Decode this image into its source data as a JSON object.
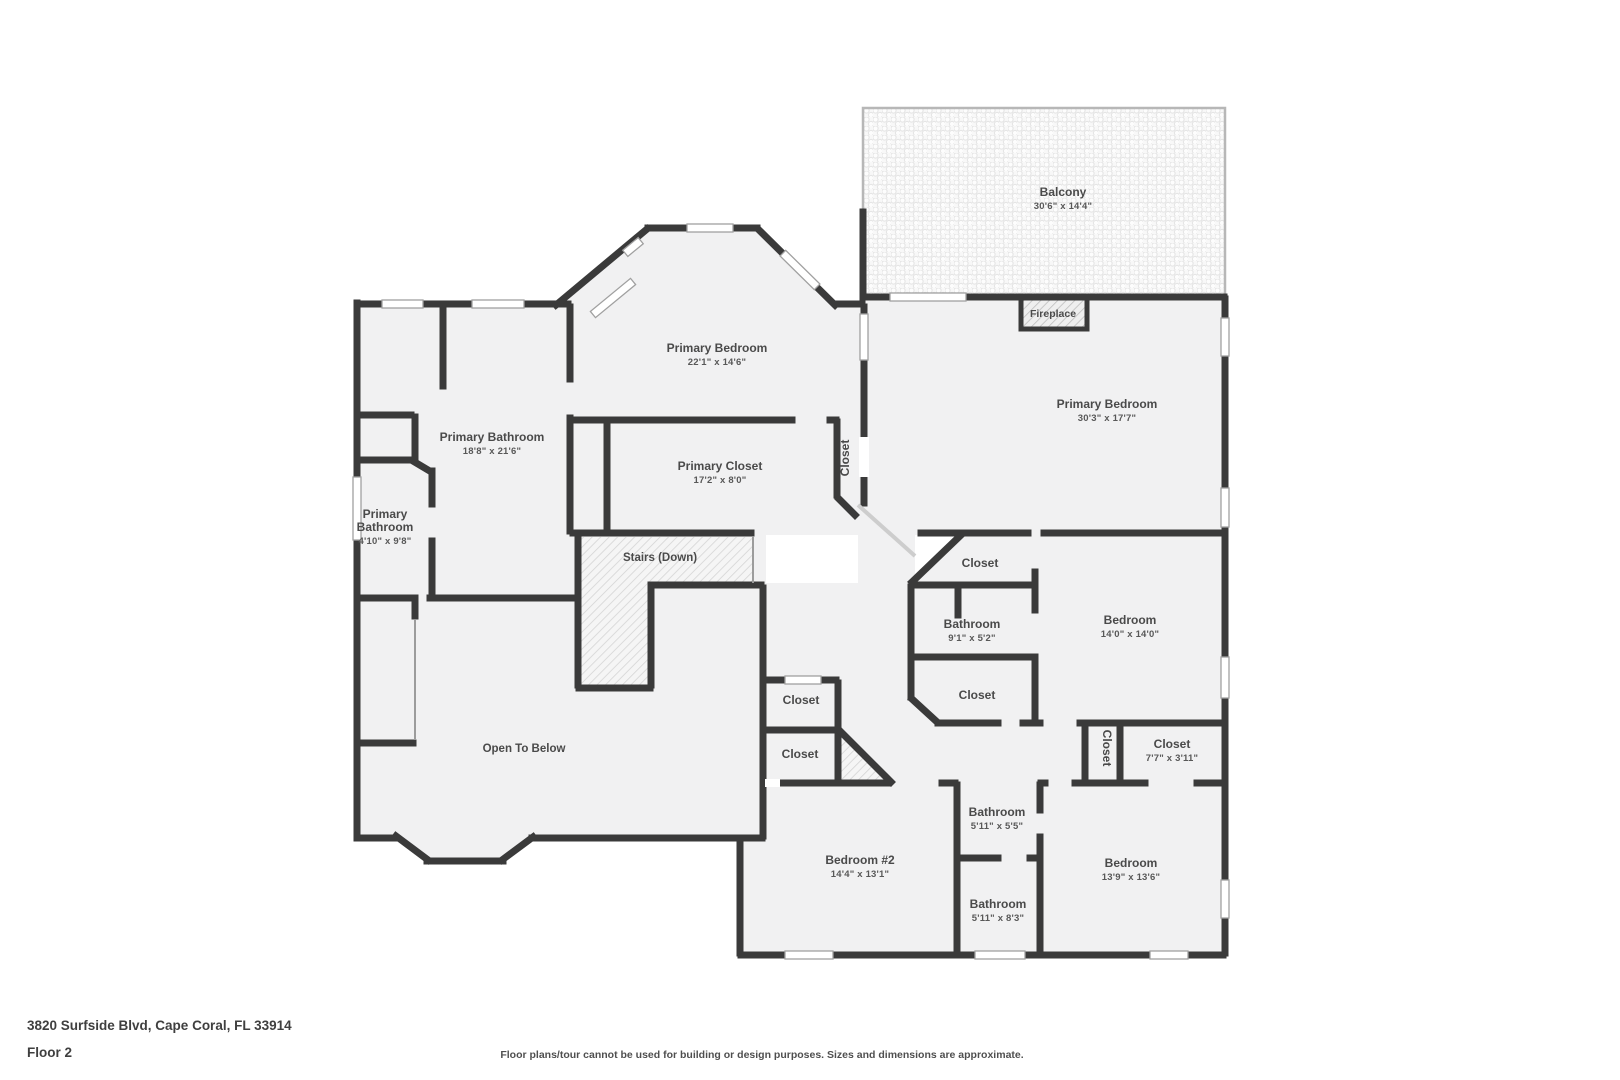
{
  "footer": {
    "address": "3820 Surfside Blvd, Cape Coral, FL 33914",
    "floor": "Floor 2",
    "disclaimer": "Floor plans/tour cannot be used for building or design purposes. Sizes and dimensions are approximate."
  },
  "colors": {
    "wall": "#3a3a3a",
    "room_fill": "#f1f1f2",
    "hatch_line": "#d4d4d4",
    "fireplace_hatch": "#bfbfbf",
    "window_stroke": "#a0a0a0",
    "balcony_dot": "#e4e4e4",
    "label": "#4a4a4a"
  },
  "plan": {
    "labels": [
      {
        "id": "balcony",
        "name": "Balcony",
        "dims": "30'6\" x 14'4\"",
        "x": 1063,
        "y": 196
      },
      {
        "id": "fireplace",
        "name": "Fireplace",
        "x": 1053,
        "y": 317,
        "size": 10.5
      },
      {
        "id": "primary-bedroom-top",
        "name": "Primary Bedroom",
        "dims": "22'1\" x 14'6\"",
        "x": 717,
        "y": 352
      },
      {
        "id": "primary-bedroom-right",
        "name": "Primary Bedroom",
        "dims": "30'3\" x 17'7\"",
        "x": 1107,
        "y": 408
      },
      {
        "id": "primary-bathroom",
        "name": "Primary Bathroom",
        "dims": "18'8\" x 21'6\"",
        "x": 492,
        "y": 441
      },
      {
        "id": "primary-bathroom-small",
        "name": "Primary",
        "name2": "Bathroom",
        "dims": "4'10\" x 9'8\"",
        "x": 385,
        "y": 518
      },
      {
        "id": "primary-closet",
        "name": "Primary Closet",
        "dims": "17'2\" x 8'0\"",
        "x": 720,
        "y": 470
      },
      {
        "id": "closet-corridor",
        "name": "Closet",
        "x": 849,
        "y": 458,
        "rot": -90
      },
      {
        "id": "stairs-down",
        "name": "Stairs (Down)",
        "x": 660,
        "y": 561,
        "size": 11.5
      },
      {
        "id": "open-to-below",
        "name": "Open To Below",
        "x": 524,
        "y": 752,
        "size": 11.5
      },
      {
        "id": "closet-cluster-top",
        "name": "Closet",
        "x": 980,
        "y": 567
      },
      {
        "id": "bathroom-mid",
        "name": "Bathroom",
        "dims": "9'1\" x 5'2\"",
        "x": 972,
        "y": 628
      },
      {
        "id": "closet-cluster-bottom",
        "name": "Closet",
        "x": 977,
        "y": 699
      },
      {
        "id": "bedroom-mid",
        "name": "Bedroom",
        "dims": "14'0\" x 14'0\"",
        "x": 1130,
        "y": 624
      },
      {
        "id": "closet-hall-1",
        "name": "Closet",
        "x": 801,
        "y": 704
      },
      {
        "id": "closet-hall-2",
        "name": "Closet",
        "x": 800,
        "y": 758
      },
      {
        "id": "closet-vertical-2",
        "name": "Closet",
        "x": 1103,
        "y": 748,
        "rot": 90
      },
      {
        "id": "closet-77",
        "name": "Closet",
        "dims": "7'7\" x 3'11\"",
        "x": 1172,
        "y": 748
      },
      {
        "id": "bedroom-2",
        "name": "Bedroom #2",
        "dims": "14'4\" x 13'1\"",
        "x": 860,
        "y": 864
      },
      {
        "id": "bathroom-top",
        "name": "Bathroom",
        "dims": "5'11\" x 5'5\"",
        "x": 997,
        "y": 816
      },
      {
        "id": "bathroom-bottom",
        "name": "Bathroom",
        "dims": "5'11\" x 8'3\"",
        "x": 998,
        "y": 908
      },
      {
        "id": "bedroom-right",
        "name": "Bedroom",
        "dims": "13'9\" x 13'6\"",
        "x": 1131,
        "y": 867
      }
    ]
  }
}
